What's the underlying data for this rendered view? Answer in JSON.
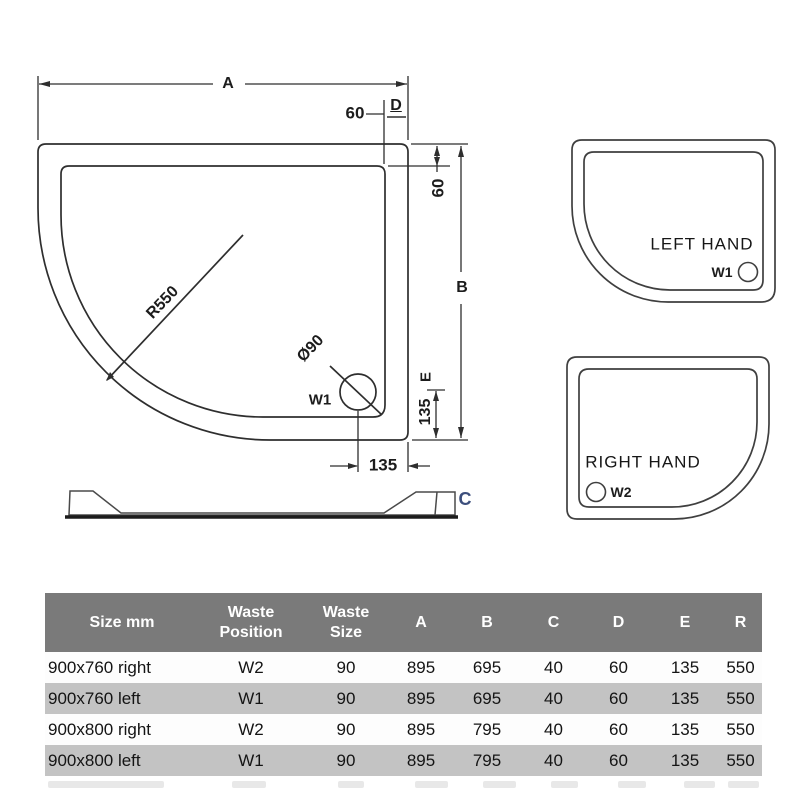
{
  "diagram": {
    "main": {
      "a": "A",
      "b": "B",
      "c": "C",
      "d": "D",
      "e": "E",
      "top_offset": "60",
      "right_offset": "60",
      "radius": "R550",
      "waste_diameter": "Ø90",
      "waste_label": "W1",
      "e_value": "135",
      "bottom_value": "135"
    },
    "left_hand": {
      "title": "LEFT HAND",
      "waste_label": "W1"
    },
    "right_hand": {
      "title": "RIGHT HAND",
      "waste_label": "W2"
    }
  },
  "table": {
    "headers": [
      "Size mm",
      "Waste Position",
      "Waste Size",
      "A",
      "B",
      "C",
      "D",
      "E",
      "R"
    ],
    "rows": [
      [
        "900x760 right",
        "W2",
        "90",
        "895",
        "695",
        "40",
        "60",
        "135",
        "550"
      ],
      [
        "900x760 left",
        "W1",
        "90",
        "895",
        "695",
        "40",
        "60",
        "135",
        "550"
      ],
      [
        "900x800 right",
        "W2",
        "90",
        "895",
        "795",
        "40",
        "60",
        "135",
        "550"
      ],
      [
        "900x800 left",
        "W1",
        "90",
        "895",
        "795",
        "40",
        "60",
        "135",
        "550"
      ]
    ]
  },
  "colors": {
    "line": "#2e2e2e",
    "header_bg": "#7a7a7a",
    "row_alt_bg": "#c3c3c3",
    "c_label": "#3c4e7c"
  }
}
